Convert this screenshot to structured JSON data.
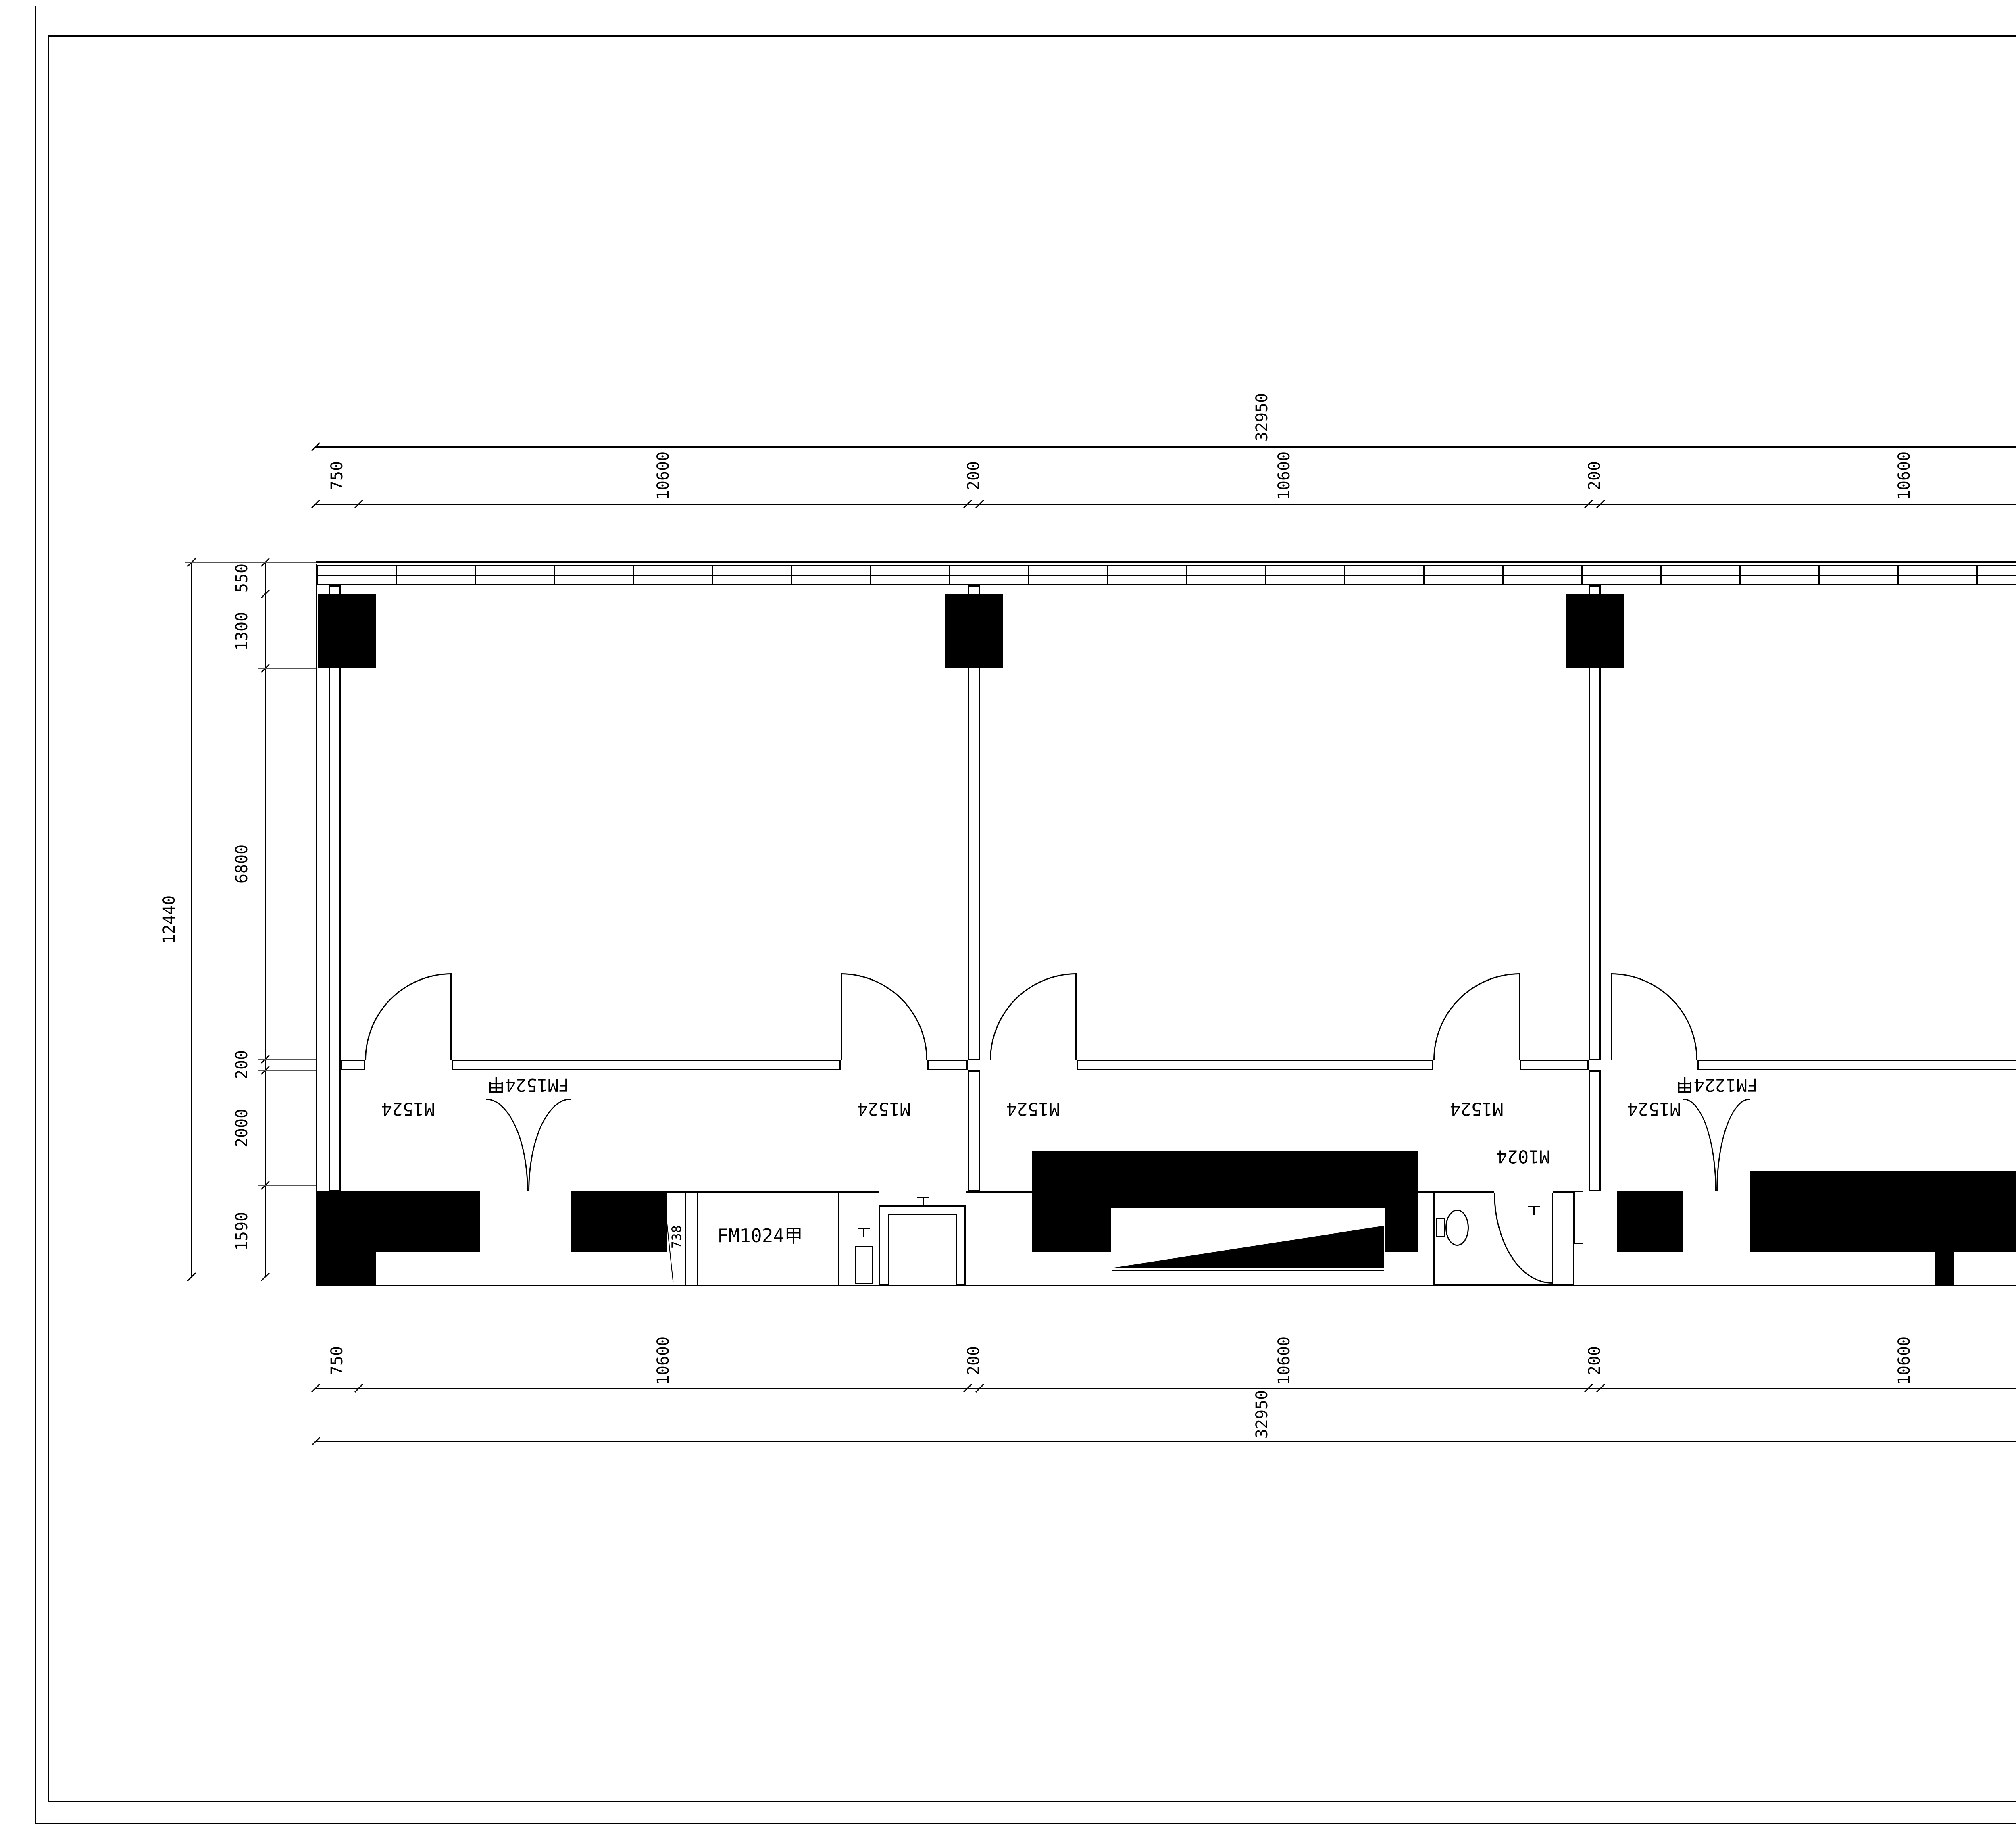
{
  "brand": {
    "logo_cn": "东方华美",
    "logo_en": "Oriental  Gorgeous",
    "red": "#e60012"
  },
  "title_block": {
    "copyright_en_lines": [
      "ORIENTAL GORGEOUS EXPRESSLY RESERVES",
      "ITS COMMON LAW COPYRIGHT AND OTHER",
      "PROPERTY RIGHTS IN THESE PLANS.THESE",
      "PLANS ARE NOT TO BE REPRODUCED CHANGED",
      "OR COPIED IN ANY FORM OR MANNER",
      "WHATSOEVER.NOR ARE THEY TO BE ASSIGHED",
      "TO ANY THIRD PARTY WITHOUT FIRST",
      "OBTAINING THE EXPRESSED WRITTEN",
      "PERMISSION AND CONSENT OF ORIENTAL",
      "GORGEOUS"
    ],
    "copyright_cn_lines": [
      "东方华美对本方案拥有版权及所有权。",
      "本方案不得以任何方式修改及复制。",
      "未经东方华美书面授权，本方案不得向",
      "任何第三方转让。"
    ],
    "sign_rows": [
      {
        "label_cn": "项目负责人",
        "label_en": "Item.Prin",
        "value": "",
        "label2_cn": "审核",
        "label2_en": "Examined",
        "value2": ""
      },
      {
        "label_cn": "专业负责人",
        "label_en": "Chief",
        "value": "",
        "label2_cn": "校对",
        "label2_en": "Checked",
        "value2": ""
      },
      {
        "label_cn": "审 定",
        "label_en": "Approved",
        "value": "",
        "label2_cn": "设计",
        "label2_en": "Designed",
        "value2": ""
      }
    ],
    "project_label_cn": "工程名称",
    "project_label_en": "Project",
    "project_name": "万科生活广场",
    "subitem_label_cn": "子项名称",
    "subitem_label_en": "Sub Item",
    "subitem_value": "",
    "title_label_cn": "图纸名称",
    "title_label_en": "Title",
    "drawing_title": "平面方案图",
    "info_rows": [
      {
        "label_cn": "工程号",
        "label_en": "Pjt .No.",
        "value": "",
        "label2_cn": "图 号",
        "label2_en": "Dwg. No.",
        "value2": ""
      },
      {
        "label_cn": "专 业",
        "label_en": "Dept.",
        "value": "1:70",
        "label2_cn": "阶 段",
        "label2_en": "Stage",
        "value2": ""
      },
      {
        "label_cn": "比 例",
        "label_en": "Scale",
        "value": "",
        "label2_cn": "日 期",
        "label2_en": "Date",
        "value2": "2016 年 3  月"
      }
    ],
    "company_name": "北京东方华美装饰工程有限公司",
    "company_branch": "合肥分公司",
    "company_address": "安徽省合肥市马鞍山南路绿地赢海大厦B座19楼",
    "phone": "电话：0551-65428999",
    "website": "http://www.hmzs.net"
  },
  "plan": {
    "dims": {
      "top_overall": "32950",
      "top_segments": [
        "750",
        "10600",
        "200",
        "10600",
        "200",
        "10600"
      ],
      "bottom_overall": "32950",
      "bottom_segments": [
        "750",
        "10600",
        "200",
        "10600",
        "200",
        "10600"
      ],
      "left_overall": "12440",
      "left_segments": [
        "550",
        "1300",
        "6800",
        "200",
        "2000",
        "1590"
      ],
      "right_overall": "12440",
      "right_segments": [
        "8650",
        "200",
        "2000",
        "1590"
      ],
      "door_dim": "738"
    },
    "door_labels": {
      "m1524": "M1524",
      "fm1524": "FM1524甲",
      "fm1024": "FM1024甲",
      "m1024": "M1024",
      "fm1224": "FM1224甲"
    }
  }
}
